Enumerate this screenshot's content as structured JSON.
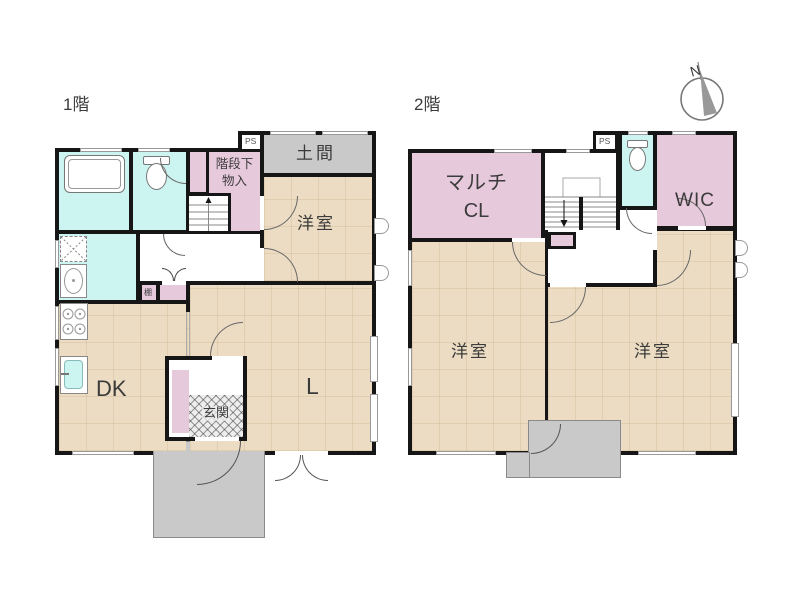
{
  "palette": {
    "wall": "#161616",
    "room_floor": "#ecdcc3",
    "closet_pink": "#e7c9dc",
    "wet_area_blue": "#ccf5f1",
    "doma_gray": "#c9c9c9"
  },
  "compass": {
    "north": "N"
  },
  "floor1": {
    "title": "1階",
    "rooms": {
      "ps": "PS",
      "doma": "土間",
      "under_stair_storage_line1": "階段下",
      "under_stair_storage_line2": "物入",
      "western_room": "洋室",
      "shelf": "棚",
      "dk": "DK",
      "living": "L",
      "entrance": "玄関"
    }
  },
  "floor2": {
    "title": "2階",
    "rooms": {
      "multi_closet_line1": "マルチ",
      "multi_closet_line2": "CL",
      "ps": "PS",
      "wic": "WIC",
      "western_room_left": "洋室",
      "western_room_right": "洋室"
    }
  }
}
